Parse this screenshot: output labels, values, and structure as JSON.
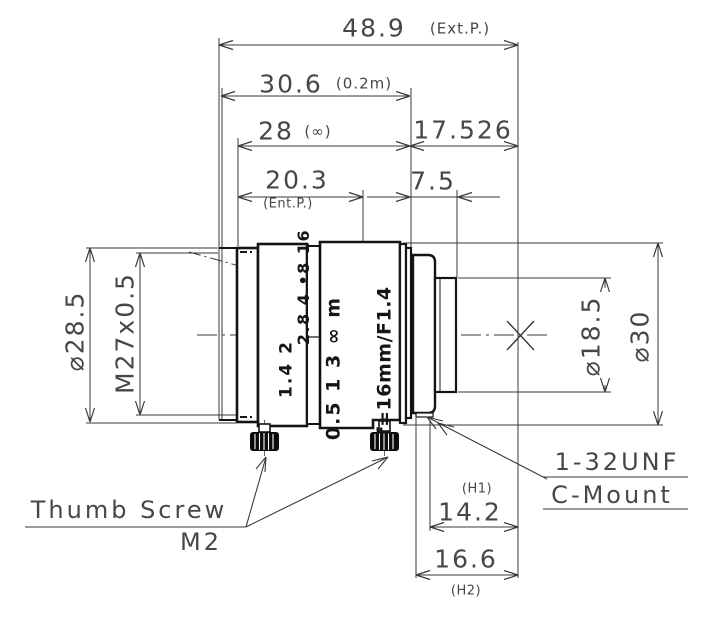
{
  "drawing": {
    "dims": {
      "total": {
        "num": "48.9",
        "note": "(Ext.P.)"
      },
      "near_focus": {
        "num": "30.6",
        "note": "(0.2m)"
      },
      "infinity": {
        "num": "28",
        "note": "(∞)"
      },
      "flange_focal": {
        "num": "17.526"
      },
      "ent_pupil": {
        "num": "20.3",
        "note": "(Ent.P.)"
      },
      "thread_len": {
        "num": "7.5"
      },
      "h1": {
        "num": "14.2",
        "note": "(H1)"
      },
      "h2": {
        "num": "16.6",
        "note": "(H2)"
      },
      "front_dia": {
        "num": "⌀28.5"
      },
      "front_thread": {
        "num": "M27x0.5"
      },
      "mount_dia": {
        "num": "⌀18.5"
      },
      "body_dia": {
        "num": "⌀30"
      }
    },
    "callouts": {
      "mount_line1": "1-32UNF",
      "mount_line2": "C-Mount",
      "screw_line1": "Thumb Screw",
      "screw_line2": "M2"
    },
    "barrel_markings": {
      "aperture_upper": "2.8 4 •8 16",
      "aperture_lower": "1.4  2",
      "focus_scale": "0.5 1 3 ∞ m",
      "name_ring": "f=16mm/F1.4"
    },
    "colors": {
      "ink": "#141414",
      "dim_line": "#3a3a3a",
      "dim_text": "#474747",
      "background": "#ffffff"
    }
  }
}
